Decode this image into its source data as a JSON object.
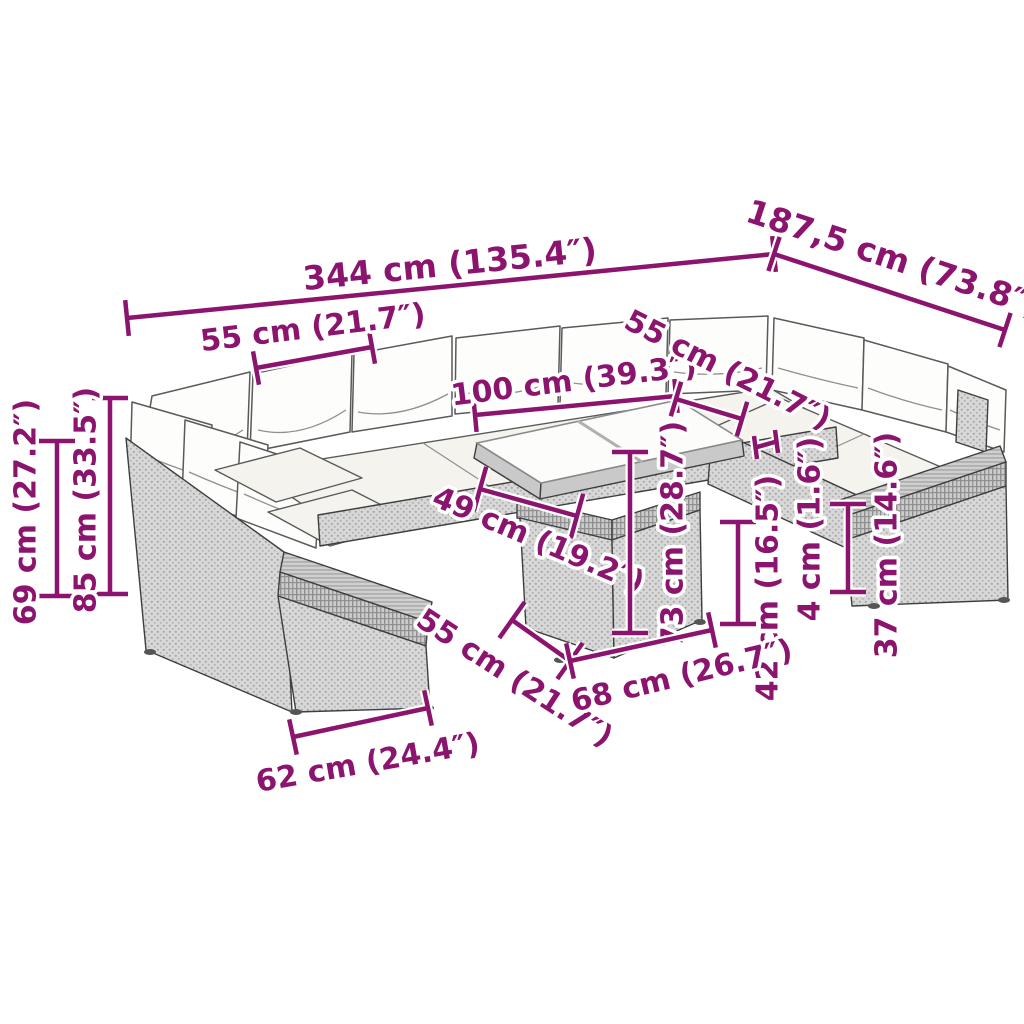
{
  "diagram": {
    "kind": "product-dimension-diagram",
    "subject": "U-shaped rattan garden lounge set with glass-top table",
    "background_color": "#ffffff",
    "annotation_color": "#8B156E",
    "furniture_outline_color": "#3e3e3e",
    "rattan_color": "#d8d8d8",
    "cushion_color": "#fdfdfb"
  },
  "dimensions": [
    {
      "id": "overall-width",
      "label": "344 cm (135.4″)"
    },
    {
      "id": "overall-depth",
      "label": "187,5 cm (73.8″)"
    },
    {
      "id": "seat-width-left",
      "label": "55 cm (21.7″)"
    },
    {
      "id": "back-section-width",
      "label": "100 cm (39.3″)"
    },
    {
      "id": "seat-width-right",
      "label": "55 cm (21.7″)"
    },
    {
      "id": "back-height",
      "label": "69 cm (27.2″)"
    },
    {
      "id": "total-height",
      "label": "85 cm (33.5″)"
    },
    {
      "id": "seat-depth",
      "label": "49 cm (19.2″)"
    },
    {
      "id": "table-height",
      "label": "73 cm (28.7″)"
    },
    {
      "id": "seat-height",
      "label": "42 cm (16.5″)"
    },
    {
      "id": "cushion-gap",
      "label": "4 cm (1.6″)"
    },
    {
      "id": "armrest-height",
      "label": "37 cm (14.6″)"
    },
    {
      "id": "table-depth",
      "label": "55 cm (21.7″)"
    },
    {
      "id": "table-width",
      "label": "68 cm (26.7″)"
    },
    {
      "id": "armrest-width",
      "label": "62 cm (24.4″)"
    }
  ]
}
